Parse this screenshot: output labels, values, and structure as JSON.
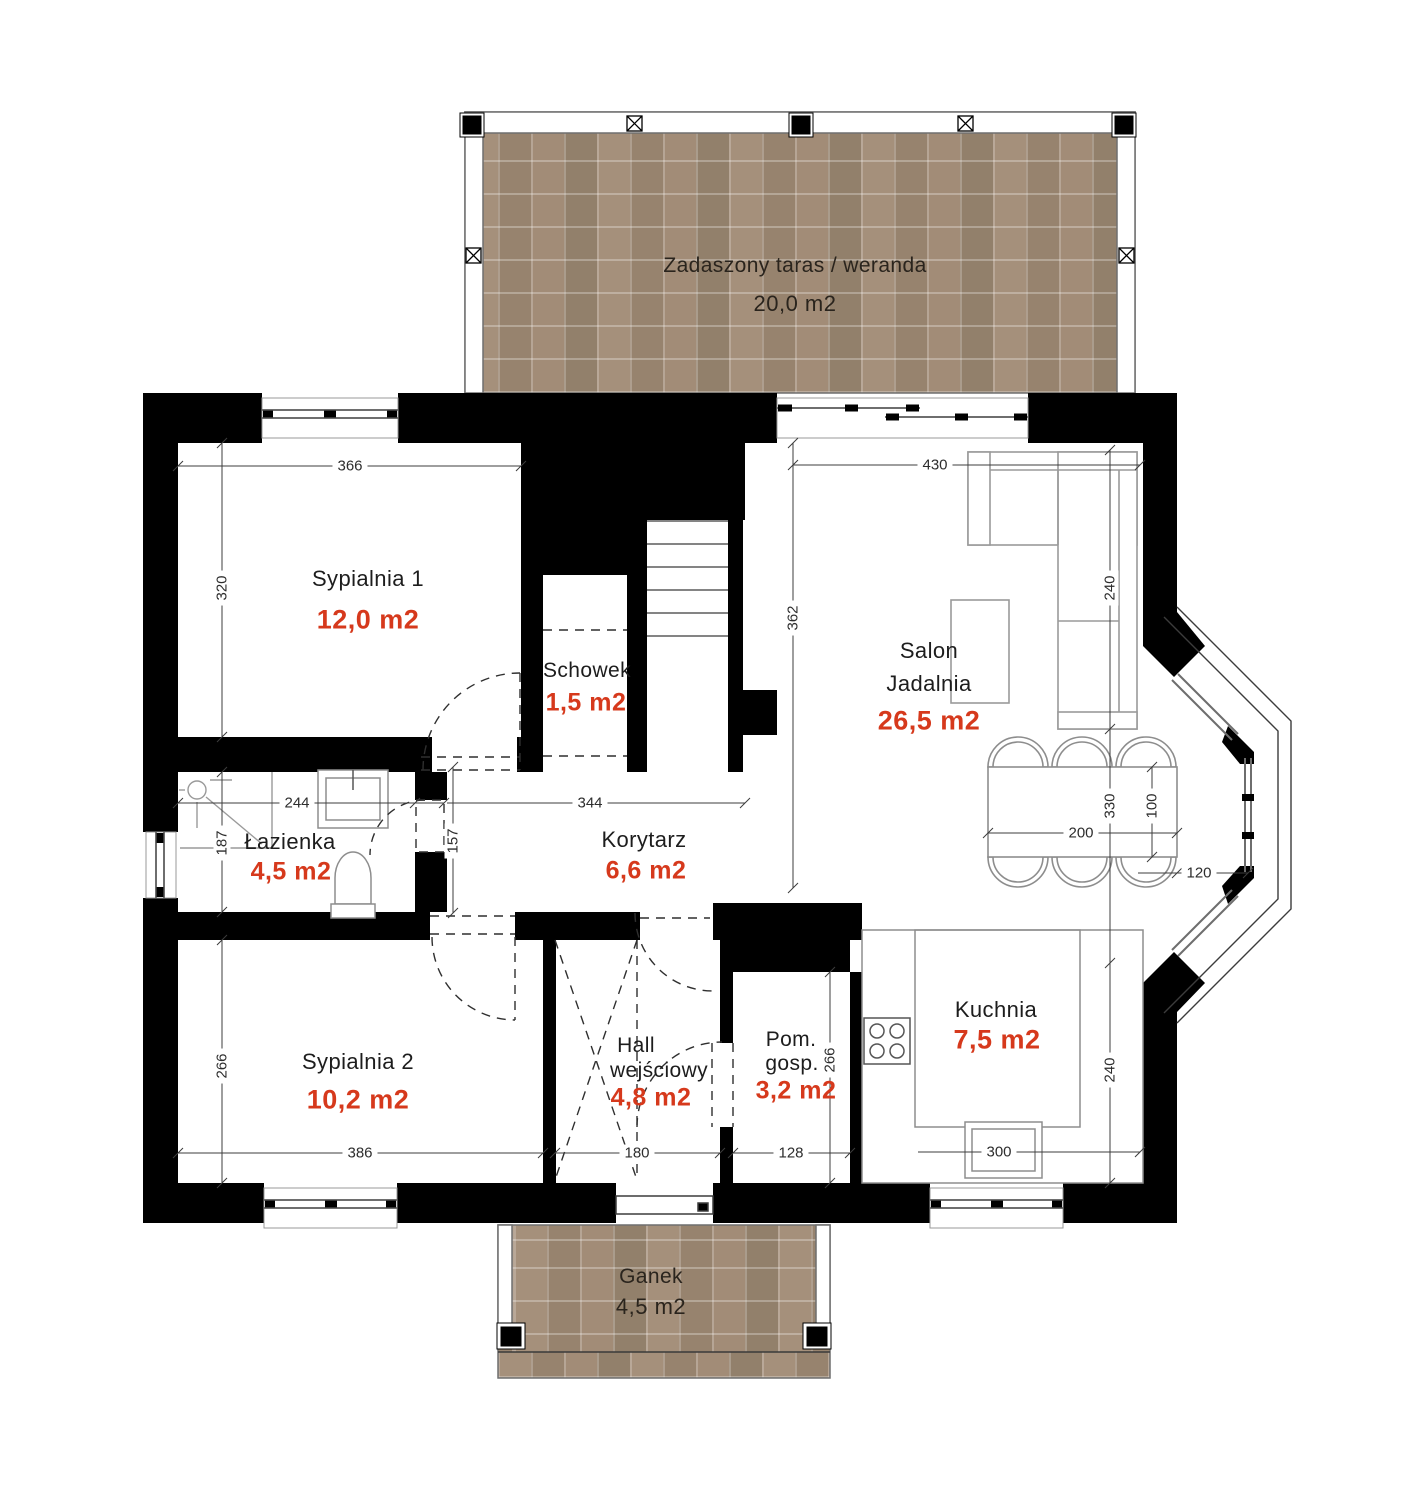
{
  "rooms": {
    "terrace": {
      "name": "Zadaszony taras / weranda",
      "area": "20,0 m2"
    },
    "syp1": {
      "name": "Sypialnia 1",
      "area": "12,0 m2"
    },
    "schowek": {
      "name": "Schowek",
      "area": "1,5 m2"
    },
    "salon": {
      "name1": "Salon",
      "name2": "Jadalnia",
      "area": "26,5 m2"
    },
    "lazienka": {
      "name": "Łazienka",
      "area": "4,5 m2"
    },
    "korytarz": {
      "name": "Korytarz",
      "area": "6,6 m2"
    },
    "syp2": {
      "name": "Sypialnia 2",
      "area": "10,2 m2"
    },
    "hall": {
      "name1": "Hall",
      "name2": "wejściowy",
      "area": "4,8 m2"
    },
    "pomgosp": {
      "name1": "Pom.",
      "name2": "gosp.",
      "area": "3,2 m2"
    },
    "kuchnia": {
      "name": "Kuchnia",
      "area": "7,5 m2"
    },
    "ganek": {
      "name": "Ganek",
      "area": "4,5 m2"
    }
  },
  "dims": {
    "syp1_w": "366",
    "syp1_h": "320",
    "salon_w": "430",
    "salon_h": "362",
    "sofa_d": "240",
    "laz_w": "244",
    "kor_w": "344",
    "laz_h": "187",
    "laz_door": "157",
    "syp2_h": "266",
    "syp2_w": "386",
    "hall_w": "180",
    "pg_w": "128",
    "pg_h": "266",
    "kuch_h": "240",
    "sink_w": "300",
    "table_l": "200",
    "dining_l": "330",
    "table_w": "100",
    "bay_gap": "120"
  },
  "colors": {
    "wall": "#000000",
    "area_value": "#d6391c",
    "paver": "#9d8874",
    "line": "#3c3c3c"
  }
}
